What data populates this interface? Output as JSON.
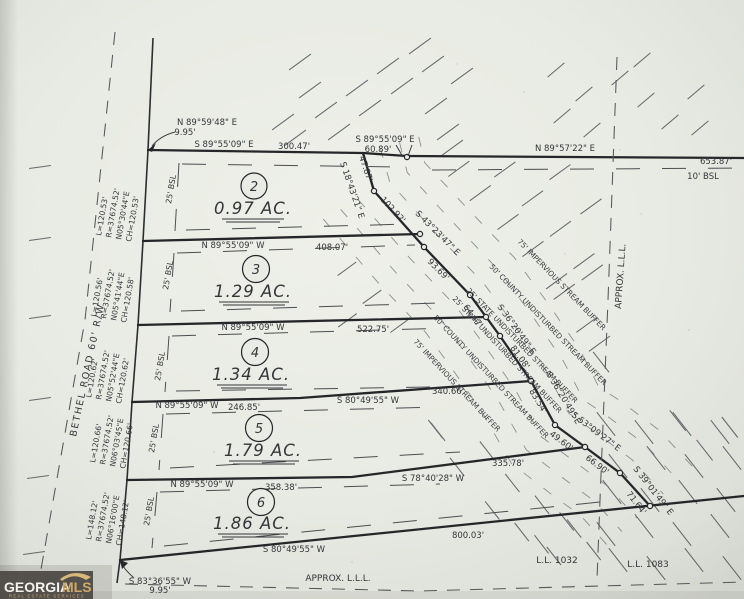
{
  "boundary": {
    "tie_north_bearing": "N 89°59'48\" E",
    "tie_north_dist": "9.95'",
    "tie_east_bearing": "S 89°55'09\" E",
    "tie_east_dist": "60.89'",
    "north_bearing": "N 89°57'22\" E",
    "north_dist": "653.87'",
    "south_bearing": "S 80°49'55\" W",
    "south_dist": "800.03'",
    "tie_south_bearing": "S 83°36'55\" W",
    "tie_south_dist": "9.95'"
  },
  "setbacks": {
    "bsl10": "10' BSL",
    "bsl25": "25' BSL"
  },
  "road": {
    "name": "BETHEL ROAD  60' R/W"
  },
  "lots": [
    {
      "num": "2",
      "acres": "0.97 AC.",
      "north_bearing": "S 89°55'09\" E",
      "north_dist": "300.47'",
      "curve": {
        "l": "L=120.53'",
        "r": "R=37674.52'",
        "brg": "N05°30'44\"E",
        "ch": "CH=120.53'"
      }
    },
    {
      "num": "3",
      "acres": "1.29 AC.",
      "north_bearing": "N 89°55'09\" W",
      "north_dist": "408.07'",
      "curve": {
        "l": "L=120.56'",
        "r": "R=37674.52'",
        "brg": "N05°41'44\"E",
        "ch": "CH=120.58'"
      }
    },
    {
      "num": "4",
      "acres": "1.34 AC.",
      "north_bearing": "N 89°55'09\" W",
      "north_dist": "522.75'",
      "curve": {
        "l": "L=120.62'",
        "r": "R=37674.52'",
        "brg": "N05°52'44\"E",
        "ch": "CH=120.62'"
      }
    },
    {
      "num": "5",
      "acres": "1.79 AC.",
      "north_bearing": "N 89°55'09\" W",
      "north_dist": "246.85'",
      "north_bearing2": "S 80°49'55\" W",
      "north_dist2": "340.66'",
      "curve": {
        "l": "L=120.66'",
        "r": "R=37674.52'",
        "brg": "N06°03'45\"E",
        "ch": "CH=120.66'"
      }
    },
    {
      "num": "6",
      "acres": "1.86 AC.",
      "north_bearing": "N 89°55'09\" W",
      "north_dist": "358.38'",
      "north_bearing2": "S 78°40'28\" W",
      "north_dist2": "335.78'",
      "curve": {
        "l": "L=148.12'",
        "r": "R=37674.52'",
        "brg": "N06°16'00\"E",
        "ch": "CH=148.12'"
      }
    }
  ],
  "stream": {
    "bearings": {
      "b1": "S 18°43'21\" E",
      "b2": "S 43°23'47\" E",
      "b3": "S 36°20'49\" E",
      "b4": "S 53°09'27\" E",
      "b5": "S 39°01'49\" E"
    },
    "dists": {
      "d1": "47.87'",
      "d2": "102.92'",
      "d3": "93.69'",
      "d4": "64.47'",
      "d5": "81.08'",
      "d6": "83.54'",
      "d7": "49.60'",
      "d8": "66.90'",
      "d9": "71.64'"
    }
  },
  "buffers": {
    "b25": "25' STATE UNDISTURBED STREAM BUFFER",
    "b50": "50' COUNTY UNDISTURBED STREAM BUFFER",
    "b75": "75' IMPERVIOUS STREAM BUFFER"
  },
  "land_lots": {
    "approx_vertical": "APPROX. L.L.L.",
    "approx_bottom": "APPROX. L.L.L.",
    "ll_west": "L.L. 1032",
    "ll_east": "L.L. 1083"
  },
  "logo": {
    "georgia": "GEORGIA",
    "mls": "MLS",
    "tagline": "REAL ESTATE SERVICES"
  }
}
